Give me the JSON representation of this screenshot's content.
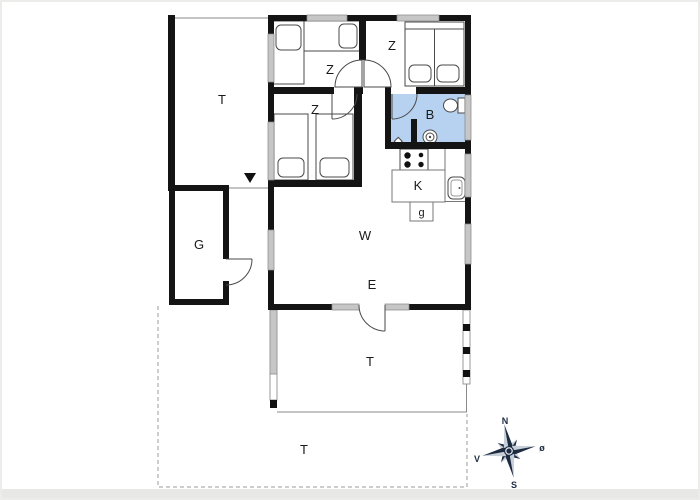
{
  "title": "Holiday house floor plan",
  "rooms": {
    "terrace_top": "T",
    "bedroom_top_left": "Z",
    "bedroom_top_right": "Z",
    "bedroom_mid_left": "Z",
    "bathroom": "B",
    "kitchen": "K",
    "utility": "g",
    "living_room": "W",
    "entry": "E",
    "garage": "G",
    "terrace_attached": "T",
    "terrace_ground": "T"
  },
  "compass": {
    "north": "N",
    "east": "ø",
    "south": "S",
    "west": "V"
  },
  "colors": {
    "wall": "#141414",
    "bathroom_fill": "#b7d1f0",
    "window_fill": "#c6c6c6",
    "compass_dark": "#1d2b40",
    "compass_light": "#c7cfd9",
    "dashed_line": "#9b9b9b"
  }
}
